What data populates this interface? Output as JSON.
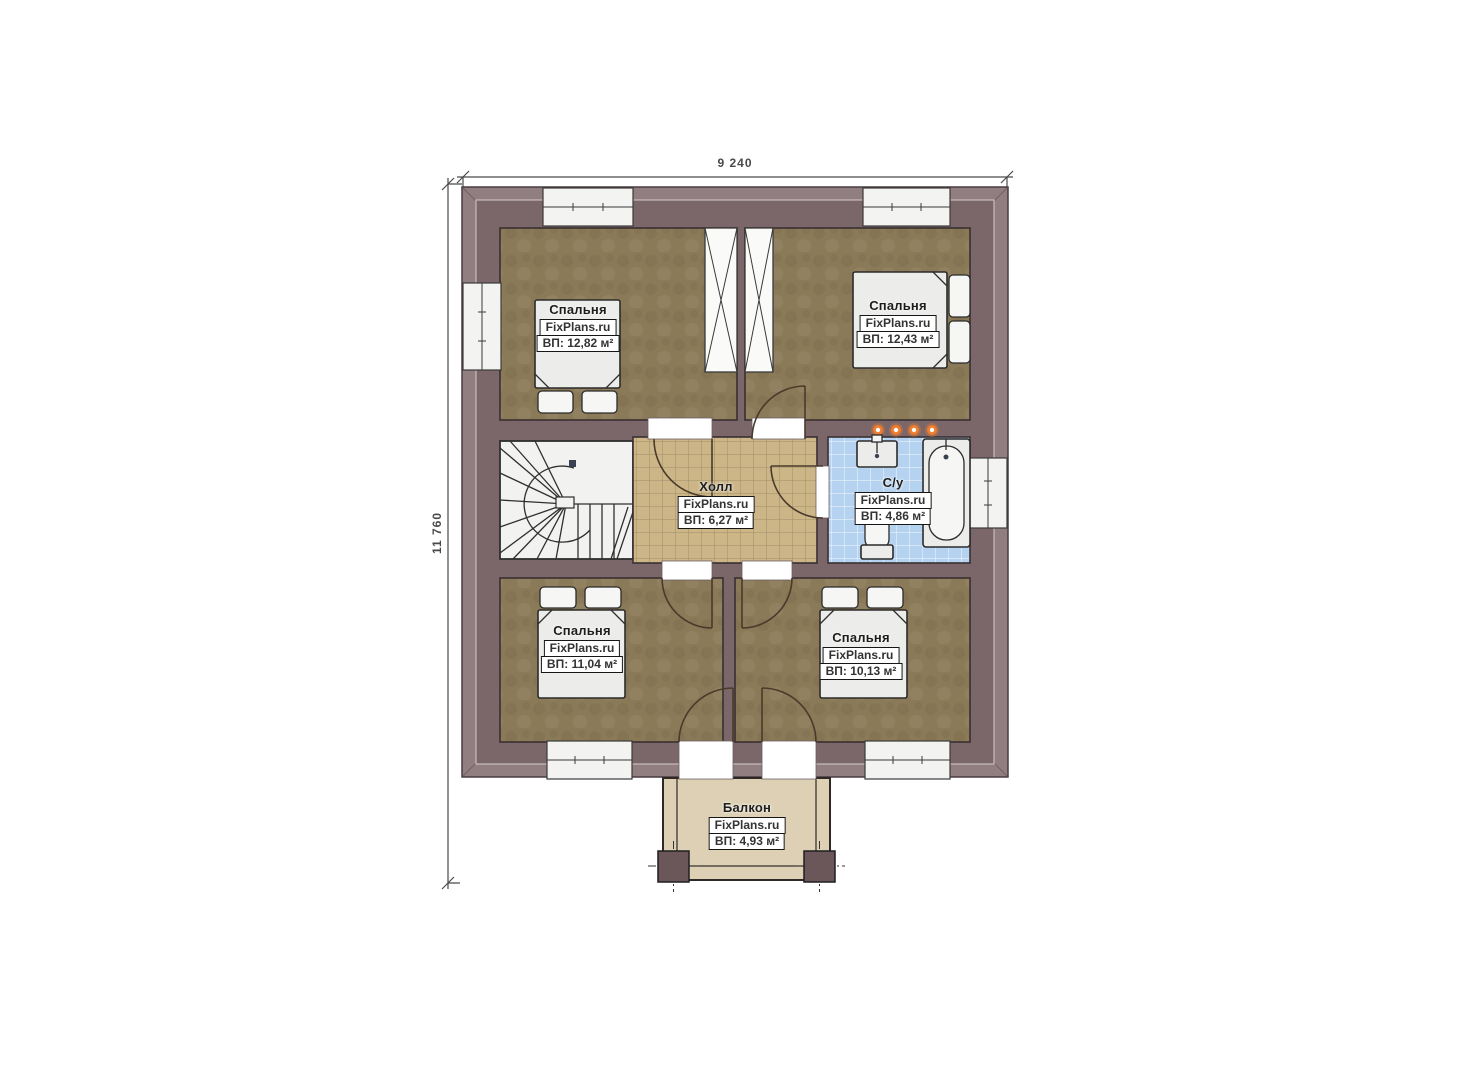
{
  "dimensions": {
    "width": "9 240",
    "height": "11 760"
  },
  "rooms": [
    {
      "id": "bedroom-top-left",
      "name": "Спальня",
      "brand": "FixPlans.ru",
      "area": "ВП: 12,82 м²"
    },
    {
      "id": "bedroom-top-right",
      "name": "Спальня",
      "brand": "FixPlans.ru",
      "area": "ВП: 12,43 м²"
    },
    {
      "id": "hall",
      "name": "Холл",
      "brand": "FixPlans.ru",
      "area": "ВП: 6,27 м²"
    },
    {
      "id": "bathroom",
      "name": "С/у",
      "brand": "FixPlans.ru",
      "area": "ВП: 4,86 м²"
    },
    {
      "id": "bedroom-bottom-left",
      "name": "Спальня",
      "brand": "FixPlans.ru",
      "area": "ВП: 11,04 м²"
    },
    {
      "id": "bedroom-bottom-right",
      "name": "Спальня",
      "brand": "FixPlans.ru",
      "area": "ВП: 10,13 м²"
    },
    {
      "id": "balcony",
      "name": "Балкон",
      "brand": "FixPlans.ru",
      "area": "ВП: 4,93 м²"
    }
  ],
  "colors": {
    "wall": "#7b6669",
    "eave": "#917e80",
    "floor-bedroom": "#8b7a58",
    "floor-hall": "#ccb687",
    "tile-line-tan": "#9e8d66",
    "floor-bath": "#b5d3f0",
    "tile-line-blue": "#e9f2fb",
    "floor-stairs": "#f2f2f0",
    "floor-balcony": "#ddd0b4",
    "furniture": "#ececea",
    "door": "#4a3a2b",
    "spotlight": "#ee7e2f",
    "dimension": "#4a4a4a"
  }
}
